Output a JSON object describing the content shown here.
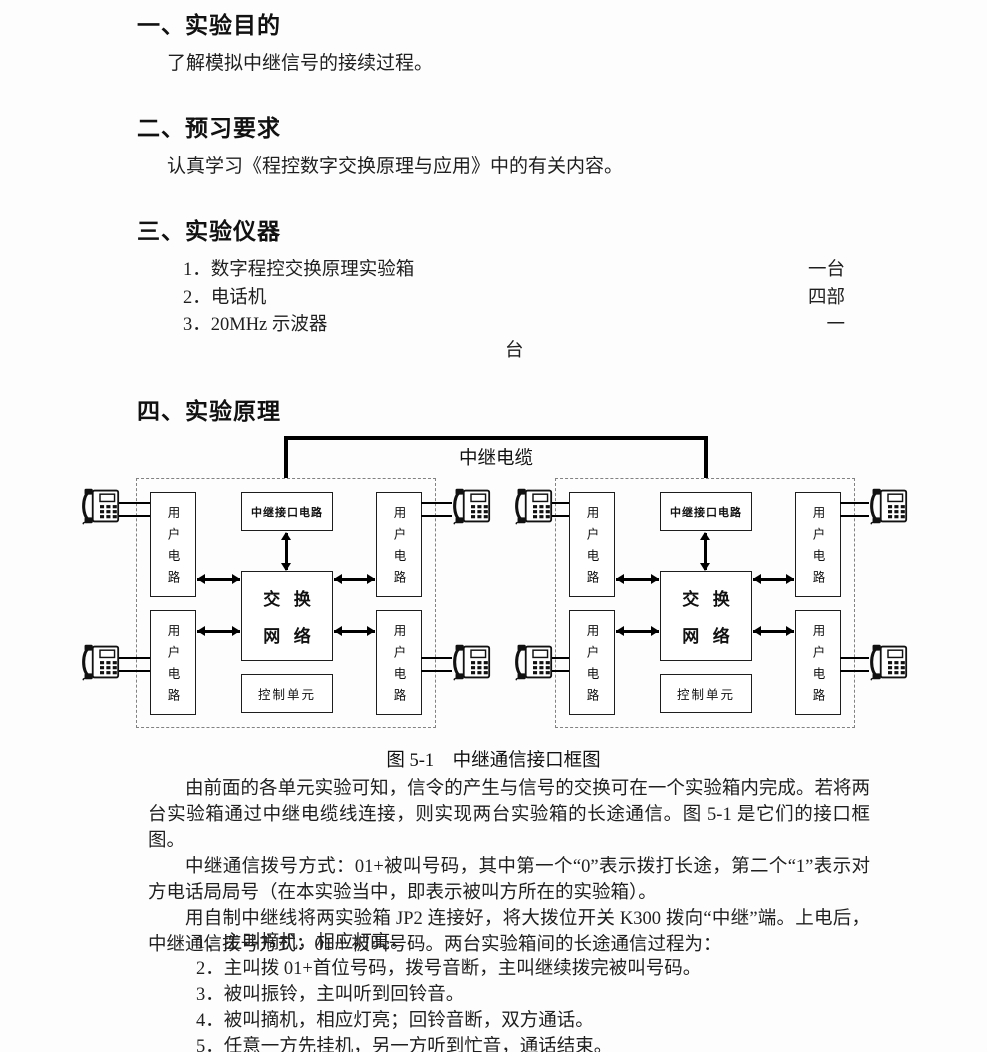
{
  "sections": {
    "s1": {
      "heading": "一、实验目的",
      "body": "了解模拟中继信号的接续过程。"
    },
    "s2": {
      "heading": "二、预习要求",
      "body": "认真学习《程控数字交换原理与应用》中的有关内容。"
    },
    "s3": {
      "heading": "三、实验仪器"
    },
    "s4": {
      "heading": "四、实验原理"
    }
  },
  "instruments": {
    "items": [
      {
        "label": "1．数字程控交换原理实验箱",
        "qty": "一台"
      },
      {
        "label": "2．电话机",
        "qty": "四部"
      },
      {
        "label": "3．20MHz 示波器",
        "qty": "一"
      }
    ],
    "qty_overflow": "台"
  },
  "diagram": {
    "trunk_cable_label": "中继电缆",
    "trunk_interface_label": "中继接口电路",
    "switch_network_line1": "交换",
    "switch_network_line2": "网络",
    "control_unit_label": "控制单元",
    "user_circuit_label": "用户电路",
    "caption": "图 5-1　中继通信接口框图"
  },
  "principle": {
    "para1": "由前面的各单元实验可知，信令的产生与信号的交换可在一个实验箱内完成。若将两台实验箱通过中继电缆线连接，则实现两台实验箱的长途通信。图 5-1 是它们的接口框图。",
    "para2": "中继通信拨号方式：01+被叫号码，其中第一个“0”表示拨打长途，第二个“1”表示对方电话局局号（在本实验当中，即表示被叫方所在的实验箱）。",
    "para3": "用自制中继线将两实验箱 JP2 连接好，将大拨位开关 K300 拨向“中继”端。上电后，中继通信拨号方式：01＋被叫号码。两台实验箱间的长途通信过程为：",
    "steps": [
      "1．主叫摘机，相应灯亮。",
      "2．主叫拨 01+首位号码，拨号音断，主叫继续拨完被叫号码。",
      "3．被叫振铃，主叫听到回铃音。",
      "4．被叫摘机，相应灯亮；回铃音断，双方通话。",
      "5．任意一方先挂机，另一方听到忙音，通话结束。"
    ]
  }
}
